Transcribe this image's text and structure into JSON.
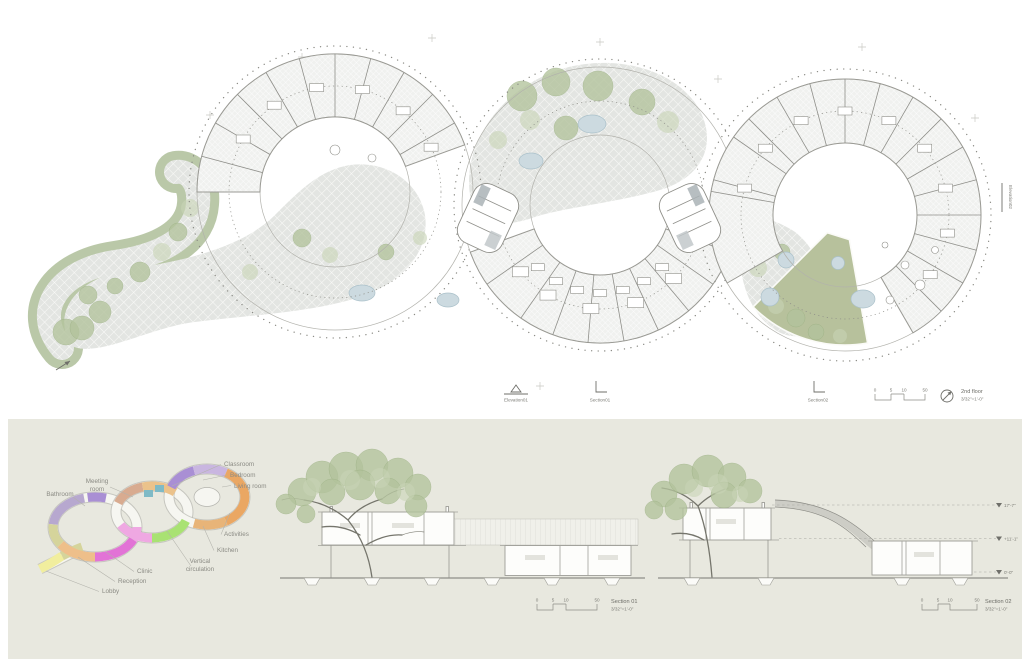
{
  "plan": {
    "title": "2nd floor",
    "scale": "3/32\"=1'-0\"",
    "scalebar": [
      "0",
      "5",
      "10",
      "50"
    ],
    "markers": {
      "elevation01": "Elevation01",
      "section01": "Section01",
      "section02": "Section02",
      "elevation02": "Elevation02"
    }
  },
  "diagram": {
    "labels": {
      "classroom": "Classroom",
      "bedroom": "Bedroom",
      "living_room": "Living room",
      "meeting_room": [
        "Meeting",
        "room"
      ],
      "bathroom": "Bathroom",
      "activities": "Activities",
      "kitchen": "Kitchen",
      "vertical_circulation": [
        "Vertical",
        "circulation"
      ],
      "clinic": "Clinic",
      "reception": "Reception",
      "lobby": "Lobby"
    }
  },
  "sections": {
    "s1": {
      "name": "Section 01",
      "scale": "3/32\"=1'-0\"",
      "scalebar": [
        "0",
        "5",
        "10",
        "50"
      ]
    },
    "s2": {
      "name": "Section 02",
      "scale": "3/32\"=1'-0\"",
      "scalebar": [
        "0",
        "5",
        "10",
        "50"
      ],
      "levels": [
        "17'-7\"",
        "+11'-1\"",
        "0'-0\""
      ]
    }
  },
  "colors": {
    "panel_bg": "#e8e8df",
    "line": "#9a9a94",
    "paving": "#e3e5e2",
    "vegetation": "#b5c4a0",
    "lawn": "#b7c19c",
    "pond": "#ccdae0",
    "program": {
      "bathroom": "#b7a8cf",
      "bedroom": "#a98fd4",
      "living_room": "#c9b6e0",
      "clinic": "#e273d6",
      "pink": "#efa8e2",
      "reception": "#eebf8a",
      "lobby": "#f1ee9e",
      "olive": "#d5d49b",
      "meeting_room": "#d8ab90",
      "classroom": "#ebc28b",
      "activities": "#eaa763",
      "kitchen": "#e8b478",
      "vertical_circulation": "#a9e273",
      "stairs": "#7fbac6"
    }
  }
}
